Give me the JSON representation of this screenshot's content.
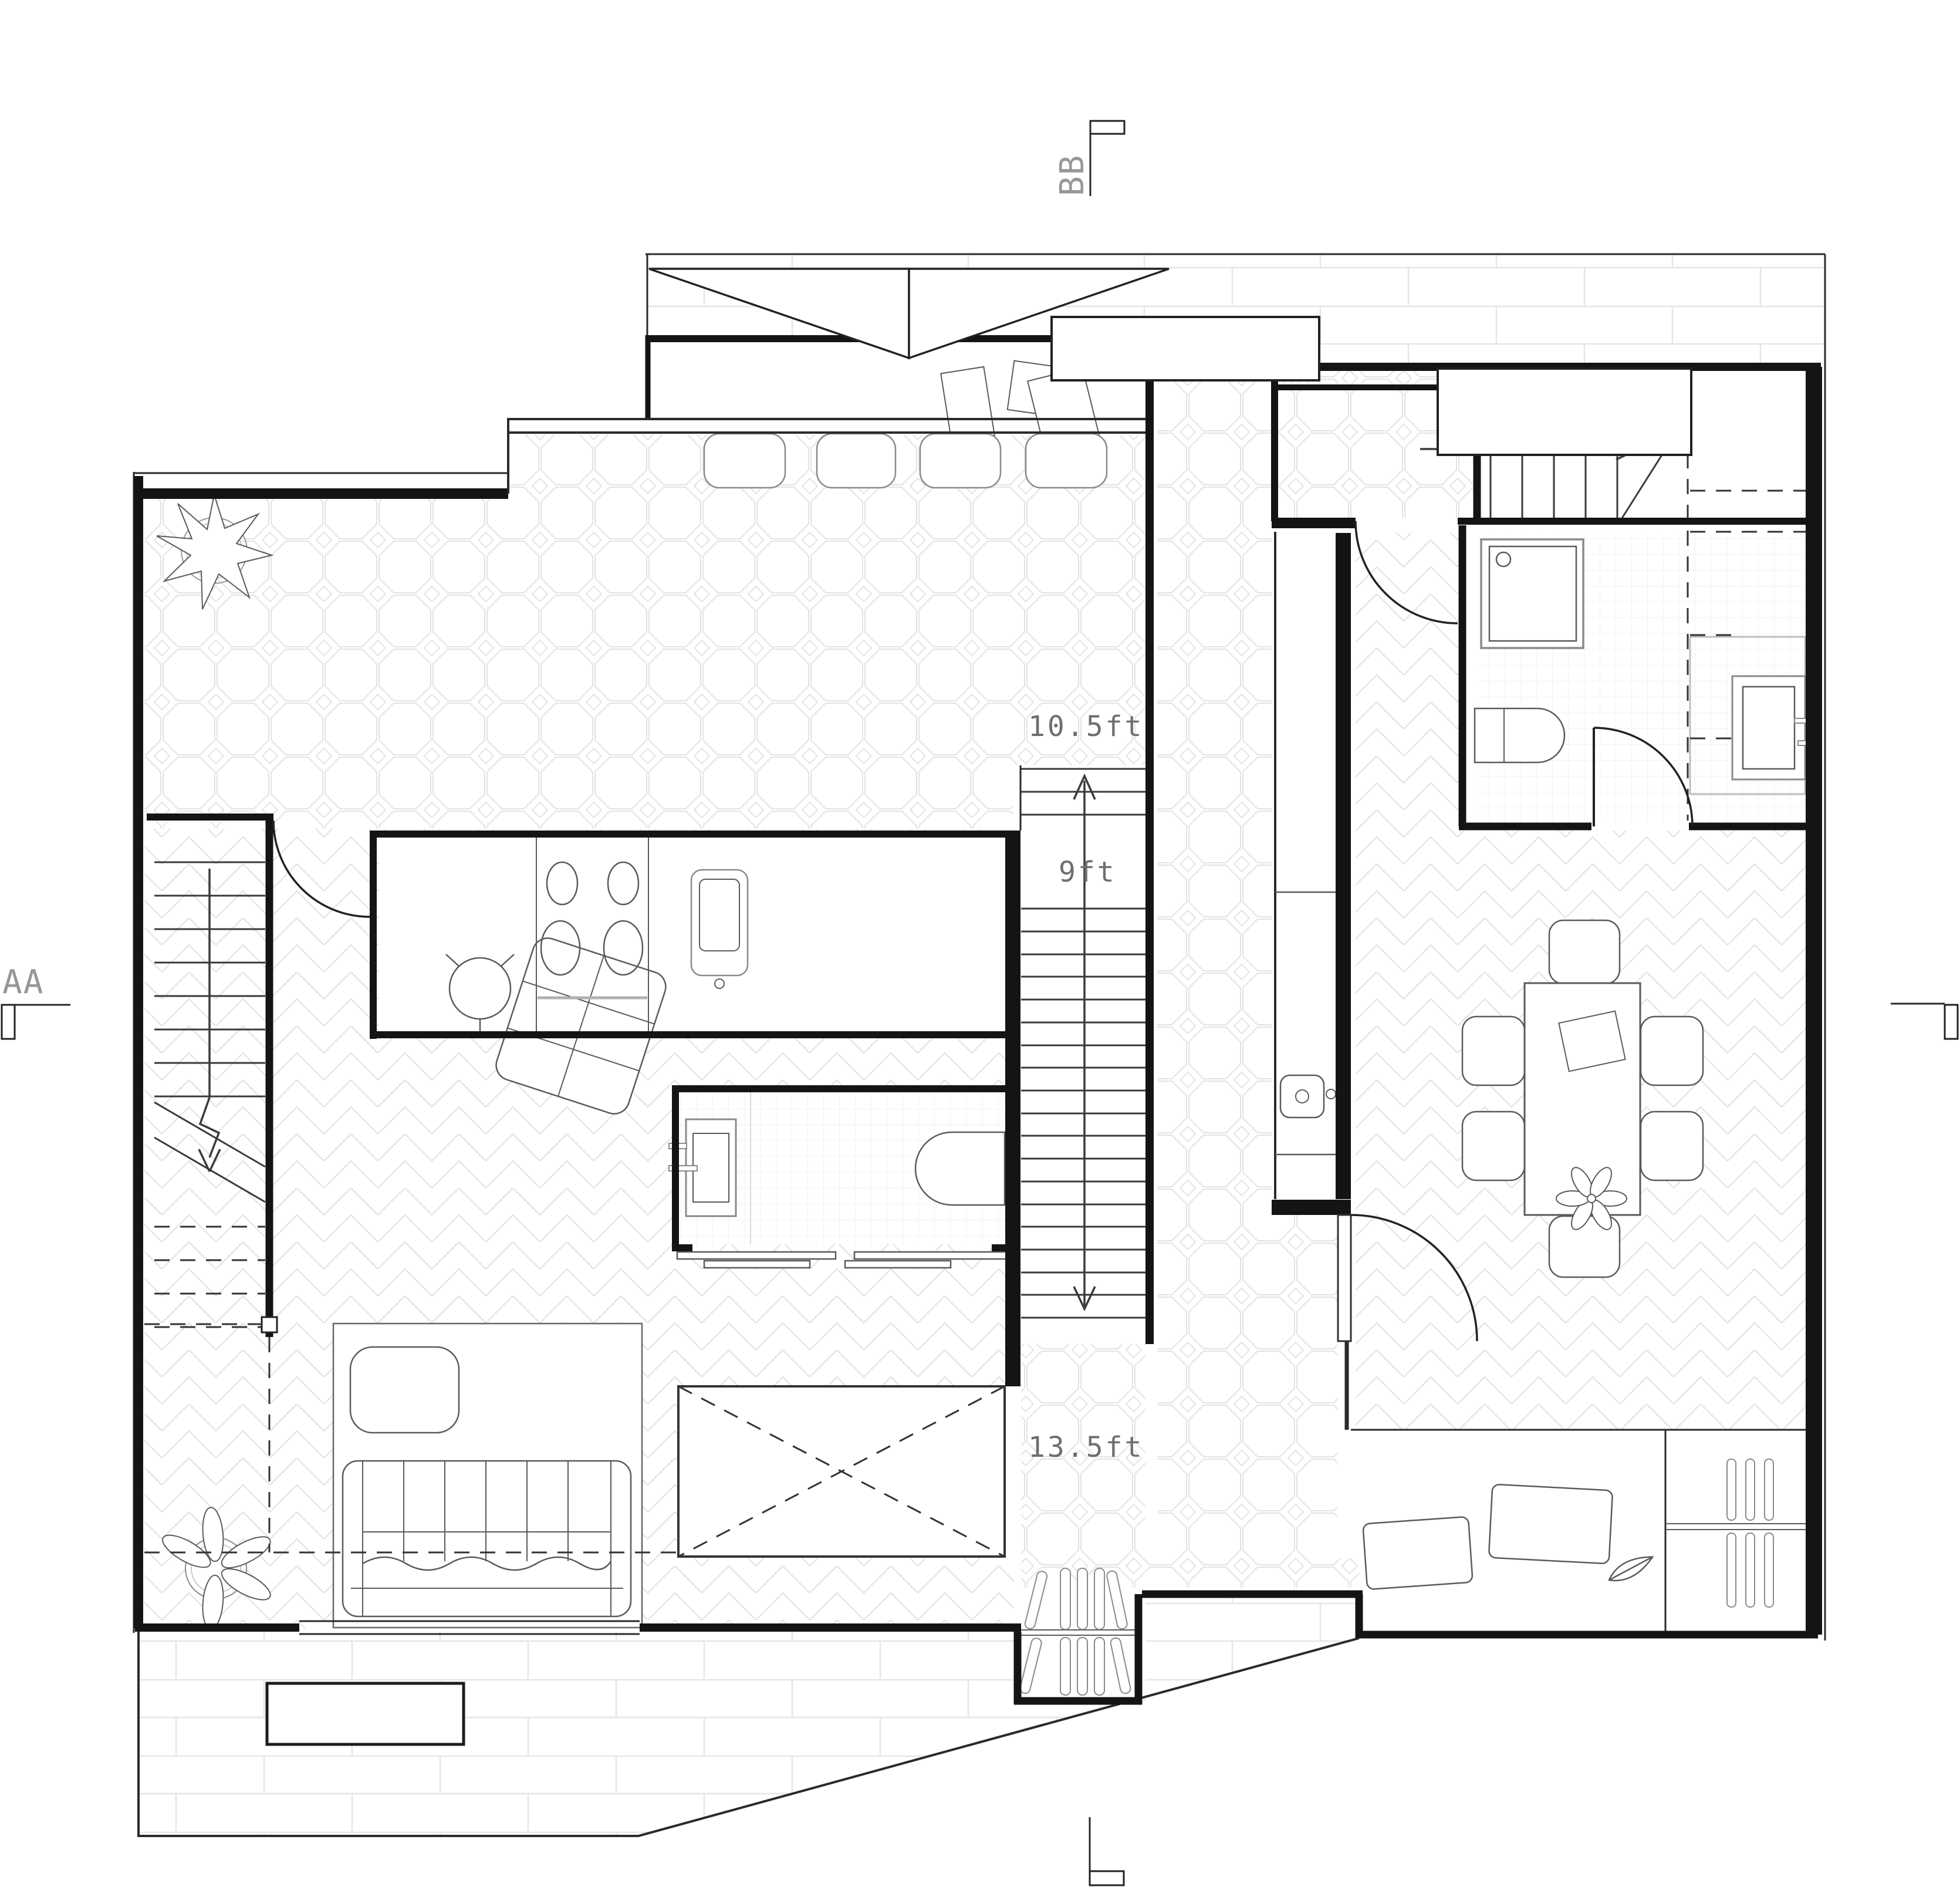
{
  "floor_plan": {
    "section_markers": {
      "top": "BB",
      "left": "AA"
    },
    "dimension_labels": {
      "stair_upper": "10.5ft",
      "stair_landing": "9ft",
      "stair_lower": "13.5ft"
    },
    "colors": {
      "wall": "#141414",
      "furniture_line": "#5a5a5a",
      "tile_line": "#e3e3e3",
      "marker_gray": "#979797",
      "dimension_gray": "#6f6f6f",
      "background": "#ffffff"
    },
    "icon_legend": [
      "plant-icon",
      "stove-icon",
      "kitchen-sink-icon",
      "bar-stool-icon",
      "sofa-icon",
      "coffee-table-icon",
      "rug-icon",
      "armchair-icon",
      "side-table-icon",
      "vanity-sink-icon",
      "bathtub-icon",
      "sliding-door-icon",
      "stair-arrow-icon",
      "shower-icon",
      "toilet-icon",
      "washing-machine-icon",
      "dining-table-icon",
      "chair-icon",
      "door-swing-icon",
      "ski-rack-icon",
      "doormat-icon",
      "planter-icon",
      "skylight-icon",
      "section-flag-icon"
    ]
  }
}
